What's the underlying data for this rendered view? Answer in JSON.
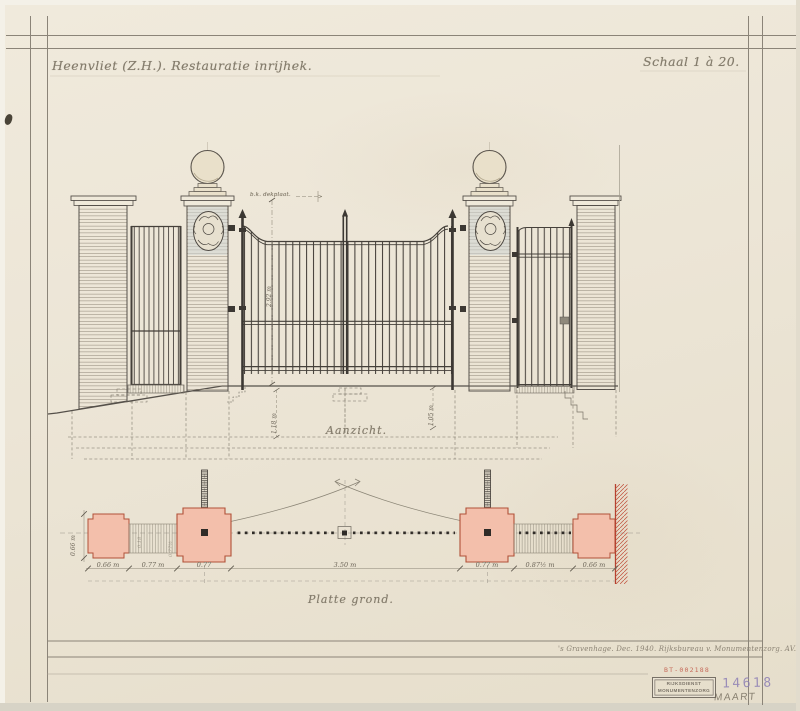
{
  "sheet": {
    "title": "Heenvliet (Z.H.). Restauratie inrijhek.",
    "scale": "Schaal 1 à 20.",
    "elevation": {
      "label": "Aanzicht.",
      "top_note": "b.k. dekplaat.",
      "dim_height": "2.92 m",
      "dim_left_foundation": "1.18 m",
      "dim_right_foundation": "1.05 m"
    },
    "plan": {
      "label": "Platte grond.",
      "dims": [
        "0.66 m",
        "0.77 m",
        "0.77",
        "3.50 m",
        "0.77 m",
        "0.87½ m",
        "0.66 m"
      ],
      "dim_depth": "0.66 m",
      "dim_step_a": "0.18",
      "dim_step_b": "0.77½"
    },
    "footer": {
      "signature": "'s Gravenhage. Dec. 1940. Rijksbureau v. Monumentenzorg. AV.",
      "ref_number": "BT-002188",
      "stamp_line1": "RIJKSDIENST",
      "stamp_line2": "MONUMENTENZORG",
      "inventory_number": "14618",
      "handwritten_note": "MAART"
    }
  },
  "colors": {
    "paper": "#ece5d6",
    "ink": "#45403a",
    "pencil": "#8b8374",
    "pier_fill": "#f3bfab",
    "pier_outline": "#b15138",
    "wall_hatch": "#c0503c",
    "stamp_purple": "#8d7fb5",
    "stamp_red": "#c05444"
  }
}
